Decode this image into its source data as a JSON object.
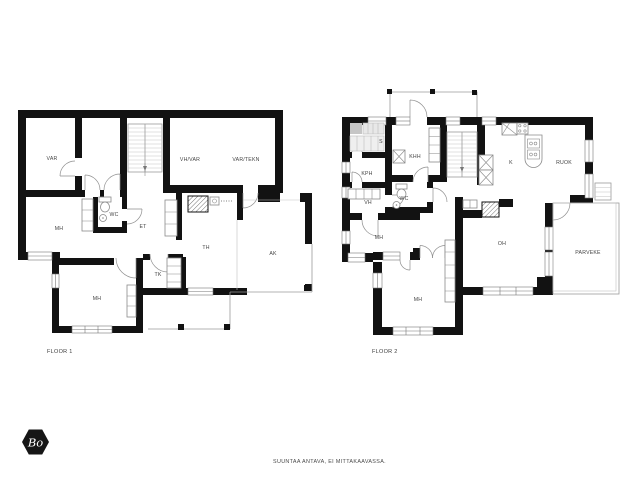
{
  "floor1": {
    "name": "FLOOR 1",
    "rooms": [
      {
        "label": "VAR"
      },
      {
        "label": "VH/VAR"
      },
      {
        "label": "VAR/TEKN"
      },
      {
        "label": "MH"
      },
      {
        "label": "WC"
      },
      {
        "label": "ET"
      },
      {
        "label": "TH"
      },
      {
        "label": "AK"
      },
      {
        "label": "TK"
      },
      {
        "label": "MH"
      }
    ]
  },
  "floor2": {
    "name": "FLOOR 2",
    "rooms": [
      {
        "label": "S"
      },
      {
        "label": "KHH"
      },
      {
        "label": "KPH"
      },
      {
        "label": "VH"
      },
      {
        "label": "WC"
      },
      {
        "label": "K"
      },
      {
        "label": "RUOK"
      },
      {
        "label": "MH"
      },
      {
        "label": "OH"
      },
      {
        "label": "PARVEKE"
      },
      {
        "label": "MH"
      }
    ]
  },
  "footer": {
    "disclaimer": "SUUNTAA ANTAVA, EI MITTAKAAVASSA."
  },
  "logo": {
    "text": "Bo"
  },
  "colors": {
    "wall": "#121212",
    "thin_line": "#9b9b9b",
    "label_text": "#454545",
    "sauna_bench": "#e8e8e8"
  }
}
